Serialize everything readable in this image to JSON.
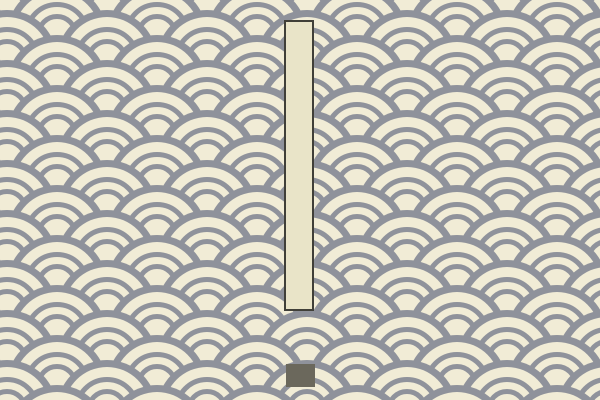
{
  "scene": {
    "description": "Game scene: seigaiha wave-pattern wallpaper background with a tall vertical bar piece and a small dark block piece near the bottom center",
    "background_pattern": {
      "name": "seigaiha-waves",
      "tile_width": 100,
      "tile_height": 50,
      "circle_radius": 50,
      "rim_inner_radius": 43,
      "inner_ring_radii": [
        30.5,
        18.5
      ],
      "inner_ring_stroke_width": 5,
      "row_spacing": 25,
      "phase_x": 57,
      "phase_y": 35
    },
    "colors": {
      "cream_bg": "#f1ecd6",
      "wave_gray": "#8f929b",
      "bar_fill": "#e9e4c8",
      "bar_border": "#403f38",
      "block_fill": "#6b685c"
    },
    "objects": {
      "tall_bar": {
        "x": 284,
        "y": 20,
        "width": 30,
        "height": 291
      },
      "small_block": {
        "x": 286,
        "y": 364,
        "width": 29,
        "height": 23
      }
    },
    "canvas": {
      "width": 600,
      "height": 400
    }
  }
}
